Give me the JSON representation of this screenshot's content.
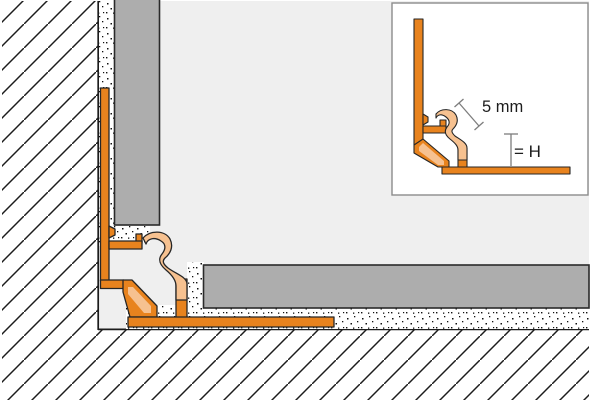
{
  "drawing": {
    "title": "Cove profile corner installation cross-section",
    "labels": {
      "dim_diagonal": "5 mm",
      "dim_height": "= H"
    },
    "colors": {
      "profile_orange": "#E8831E",
      "profile_peach": "#F6C190",
      "tile_gray": "#ADADAD",
      "interior_gray": "#EFEFEF",
      "mortar_white": "#FFFFFF",
      "outline_dark": "#1C1C1C",
      "dimension_line_gray": "#7D7D7D",
      "label_text": "#1D1D1D",
      "inset_border": "#8C8C8C"
    }
  }
}
